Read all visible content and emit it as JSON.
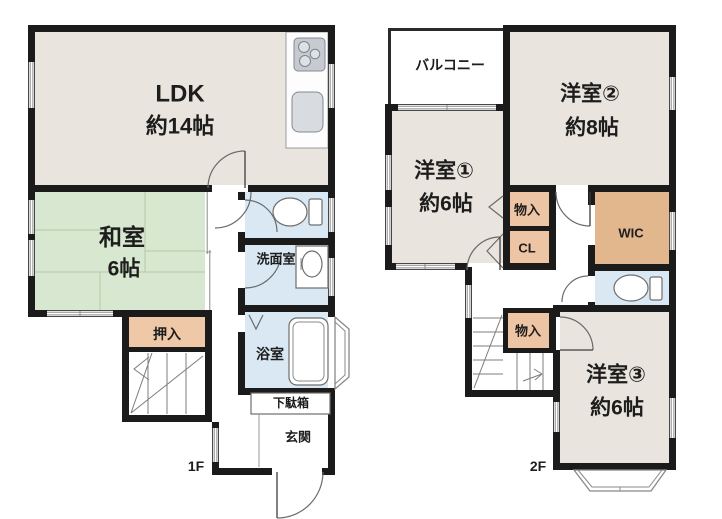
{
  "floors": {
    "f1": {
      "label": "1F",
      "rooms": {
        "ldk": {
          "name": "LDK",
          "size": "約14帖"
        },
        "washitsu": {
          "name": "和室",
          "size": "6帖"
        },
        "oshiire": {
          "name": "押入"
        },
        "senmenshitsu": {
          "name": "洗面室"
        },
        "yokushitsu": {
          "name": "浴室"
        },
        "getabako": {
          "name": "下駄箱"
        },
        "genkan": {
          "name": "玄関"
        }
      }
    },
    "f2": {
      "label": "2F",
      "rooms": {
        "balcony": {
          "name": "バルコニー"
        },
        "yoshitsu1": {
          "name": "洋室①",
          "size": "約6帖"
        },
        "yoshitsu2": {
          "name": "洋室②",
          "size": "約8帖"
        },
        "yoshitsu3": {
          "name": "洋室③",
          "size": "約6帖"
        },
        "monoire_upper": {
          "name": "物入"
        },
        "closet": {
          "name": "CL"
        },
        "wic": {
          "name": "WIC"
        },
        "monoire_stairs": {
          "name": "物入"
        }
      }
    }
  },
  "colors": {
    "wall": "#1b1b1b",
    "western_room": "#e9e4dd",
    "tatami_room": "#d8e7d0",
    "closet": "#efc8a8",
    "wic": "#e3b78e",
    "wet_area": "#d9e8f2",
    "background": "#ffffff"
  },
  "icons": {
    "stove": "three burner circles",
    "kitchen_sink": "rounded rectangle",
    "toilet": "bowl with tank",
    "washbasin": "oval basin",
    "bathtub": "double rounded rectangle",
    "stairs": "tread lines with up arrow",
    "door": "quarter-circle swing arc",
    "window": "double parallel lines"
  }
}
